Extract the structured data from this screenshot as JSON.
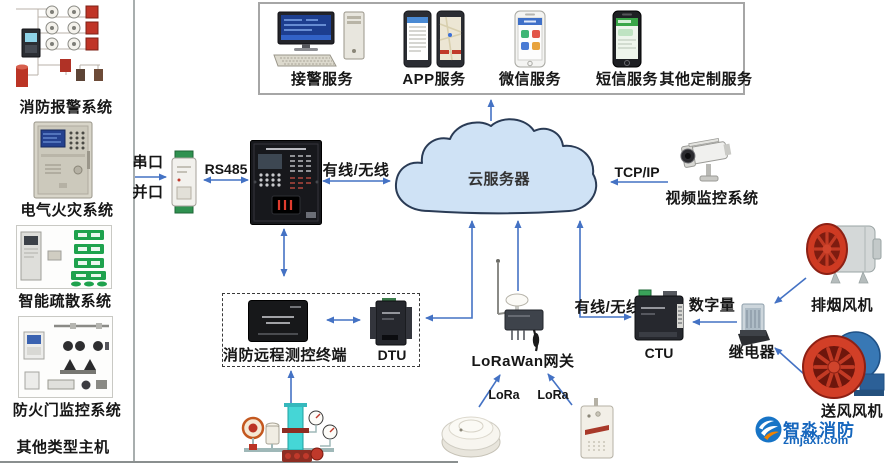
{
  "colors": {
    "arrow": "#4472c4",
    "cloud_fill": "#cfe2f5",
    "cloud_stroke": "#2a3b55",
    "services_box_border": "#a6a6a6",
    "dashed_box_border": "#3a3a3a",
    "fan_red": "#d23f27",
    "fan_blue": "#3878b5",
    "exit_green": "#1ea24d",
    "watermark_blue": "#1566bd",
    "watermark_orange": "#f08300"
  },
  "sidebar": {
    "items": [
      {
        "label": "消防报警系统",
        "icon": "fire-alarm-system-image"
      },
      {
        "label": "电气火灾系统",
        "icon": "electrical-fire-panel-image"
      },
      {
        "label": "智能疏散系统",
        "icon": "evacuation-system-image"
      },
      {
        "label": "防火门监控系统",
        "icon": "fire-door-monitor-image"
      },
      {
        "label": "其他类型主机",
        "icon": "none"
      }
    ]
  },
  "services": {
    "items": [
      {
        "label": "接警服务",
        "icon": "alarm-workstation-icon"
      },
      {
        "label": "APP服务",
        "icon": "app-phones-icon"
      },
      {
        "label": "微信服务",
        "icon": "wechat-phone-icon"
      },
      {
        "label": "短信服务",
        "icon": "sms-phone-icon"
      },
      {
        "label": "其他定制服务",
        "icon": "none"
      }
    ]
  },
  "cloud": {
    "label": "云服务器"
  },
  "edges": {
    "serial_port": "串口",
    "parallel_port": "并口",
    "rs485": "RS485",
    "wired_wireless_left": "有线/无线",
    "tcp_ip": "TCP/IP",
    "wired_wireless_right": "有线/无线",
    "digital_io": "数字量",
    "lora_left": "LoRa",
    "lora_right": "LoRa"
  },
  "nodes": {
    "video_system": "视频监控系统",
    "remote_terminal": "消防远程测控终端",
    "dtu": "DTU",
    "lorawan_gateway": "LoRaWan网关",
    "ctu": "CTU",
    "relay": "继电器",
    "smoke_exhaust_fan": "排烟风机",
    "air_supply_fan": "送风风机"
  },
  "watermark": {
    "brand": "智淼消防",
    "domain": "zmjaxf.com"
  }
}
